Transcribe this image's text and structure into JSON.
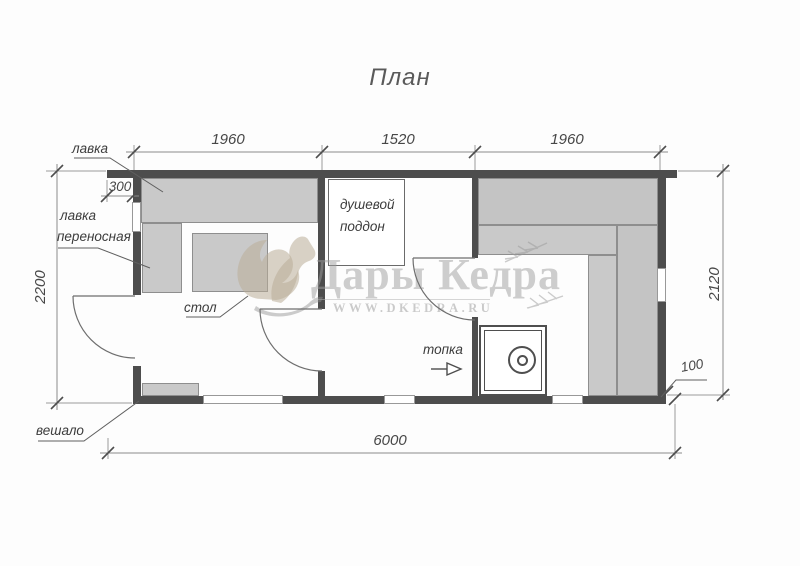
{
  "title": "План",
  "room_labels": {
    "bench": "лавка",
    "portable_bench_line1": "лавка",
    "portable_bench_line2": "переносная",
    "table": "стол",
    "shower_line1": "душевой",
    "shower_line2": "поддон",
    "firebox": "топка",
    "hanger": "вешало"
  },
  "dimensions": {
    "top": [
      "1960",
      "1520",
      "1960"
    ],
    "overall_width": "6000",
    "left_height": "2200",
    "right_height": "2120",
    "wall_offset": "300",
    "bottom_offset": "100"
  },
  "watermark": {
    "brand": "Дары Кедра",
    "url": "WWW.DKEDRA.RU"
  },
  "colors": {
    "wall": "#4d4d4d",
    "bench_fill": "#c9c9c9",
    "bench_border": "#8e8e8e",
    "dimension_line": "#8a8a8a",
    "label_text": "#3c3c3c",
    "watermark_text": "#9e9e9e",
    "watermark_squirrel": "#baad97"
  }
}
